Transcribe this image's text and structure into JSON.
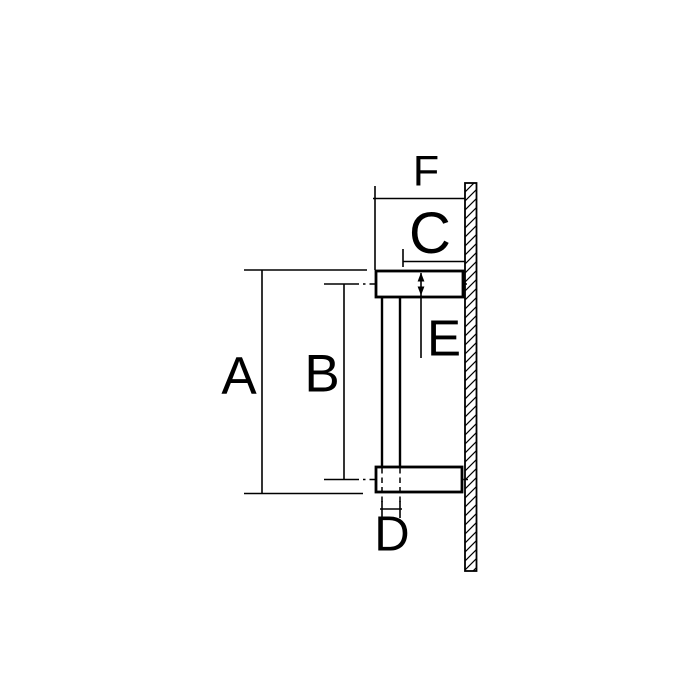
{
  "drawing": {
    "labels": {
      "a": "A",
      "b": "B",
      "c": "C",
      "d": "D",
      "e": "E",
      "f": "F"
    },
    "colors": {
      "line": "#000000",
      "background": "#ffffff"
    }
  }
}
